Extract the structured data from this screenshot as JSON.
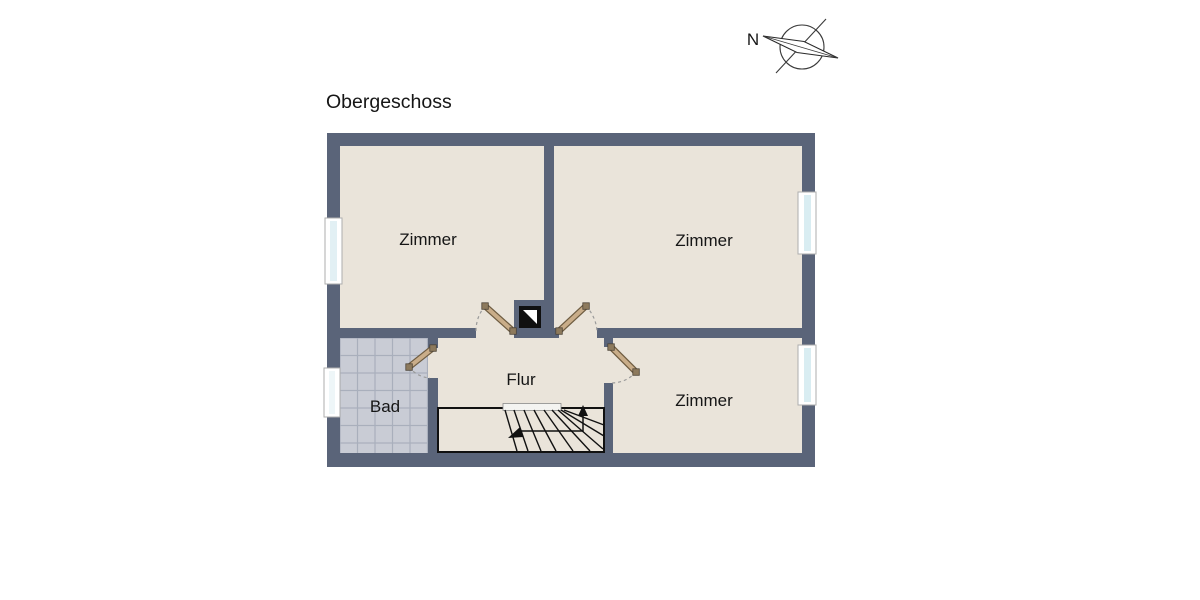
{
  "title": "Obergeschoss",
  "compass": {
    "north_label": "N"
  },
  "floorplan": {
    "rooms": [
      {
        "id": "zimmer-top-left",
        "label": "Zimmer"
      },
      {
        "id": "zimmer-top-right",
        "label": "Zimmer"
      },
      {
        "id": "zimmer-bottom-right",
        "label": "Zimmer"
      },
      {
        "id": "bad",
        "label": "Bad"
      },
      {
        "id": "flur",
        "label": "Flur"
      }
    ],
    "symbols": [
      "compass-rose",
      "staircase-up-arrow",
      "shaft-symbol",
      "window",
      "door-swing"
    ],
    "colors": {
      "wall": "#5a6479",
      "floor": "#eae4da",
      "bath_tile": "#c9ccd5",
      "tile_grout": "#a9afbc",
      "door_leaf": "#c9ad89",
      "door_leaf_dark": "#6e5c41",
      "window_glass": "#d9edf2",
      "outline": "#111111"
    }
  }
}
